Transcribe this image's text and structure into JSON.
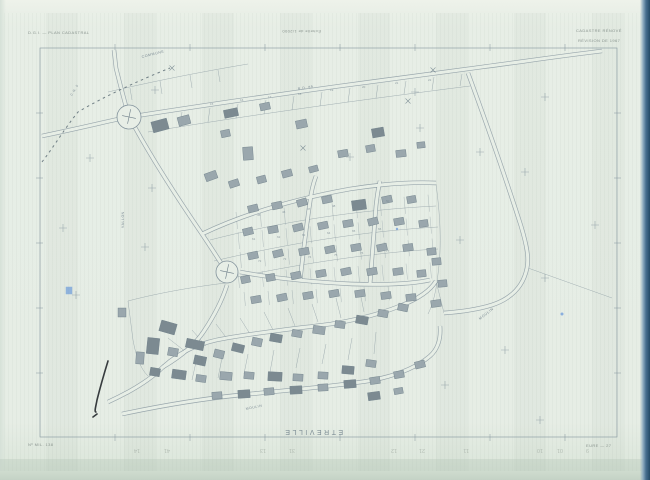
{
  "sheet": {
    "title": "Plan cadastral – feuille scannée"
  },
  "header": {
    "left": "D.G.I. — PLAN CADASTRAL",
    "scale": "Échelle de 1/2000",
    "right1": "CADASTRE RÉNOVÉ",
    "right2": "RÉVISION DE 1967"
  },
  "footer": {
    "left": "Nº MIL. 138",
    "right": "EURE — 27",
    "commune": "ETREVILLE"
  },
  "colors": {
    "paper": "#e7eee6",
    "ink": "#84949d",
    "ink_dark": "#6d7e88",
    "building": "#9aa7ad",
    "building_dark": "#7c8a91",
    "boundary": "#5d6d76",
    "text": "#7c8b94",
    "pencil": "#a7b1a8",
    "blue": "#4d86d8",
    "pen": "#23282c"
  },
  "map": {
    "border": {
      "x": 40,
      "y": 48,
      "w": 577,
      "h": 389,
      "xticks": [
        115,
        190,
        265,
        340,
        415,
        490,
        565
      ],
      "yticks": [
        113,
        178,
        243,
        308,
        373
      ]
    },
    "roads": [
      "M42,136 C90,126 112,120 129,117 C180,109 260,97 340,86 C400,78 452,71 482,67 C520,62 560,56 602,51",
      "M129,117 C124,100 120,84 116,68 L114,50",
      "M132,122 C150,155 176,196 202,234 C214,252 221,263 226,271",
      "M240,272 C272,278 312,282 352,284 C385,285 412,284 430,280",
      "M227,285 C222,301 214,316 204,331 C195,345 180,357 163,367",
      "M108,402 C130,392 150,380 163,367 C182,350 202,342 227,338 C262,332 300,328 331,324 C356,320 380,314 400,306 C418,299 430,291 436,281",
      "M122,414 C160,406 200,399 240,395 C280,391 330,387 368,381 C396,376 416,368 430,356 C438,349 441,338 440,326",
      "M300,281 C303,255 306,228 310,202 C311,193 313,184 316,176",
      "M370,284 C372,258 374,232 376,206 C377,197 378,189 380,181",
      "M468,73 C486,122 505,176 521,226 C527,246 529,258 527,268 C523,288 510,299 492,305 C476,310 458,312 444,313",
      "M202,234 C248,212 300,198 350,189 C382,184 412,182 436,183"
    ],
    "parcel_lines": [
      "M148,132 C250,115 360,100 470,86",
      "M180,127 L182,112",
      "M208,122 L210,108",
      "M236,118 L238,104",
      "M264,114 L266,100",
      "M292,110 L294,96",
      "M320,106 L322,92",
      "M348,102 L350,88",
      "M376,98 L378,85",
      "M404,94 L406,81",
      "M432,90 L434,77",
      "M460,86 L462,74",
      "M108,92 C150,82 200,72 248,64",
      "M130,88 L132,100",
      "M160,81 L162,94",
      "M190,75 L192,88",
      "M218,70 L220,82",
      "M436,184 C440,214 442,244 438,274 C436,292 433,304 428,314",
      "M210,240 C280,222 356,210 436,206",
      "M214,261 C290,243 366,231 438,227",
      "M219,281 C300,263 380,252 438,249",
      "M468,74 C488,128 508,182 524,232 C529,247 530,258 528,268",
      "M528,268 C556,278 584,288 612,298",
      "M128,301 C162,292 200,286 226,283",
      "M128,301 L133,340 C136,356 140,368 148,376",
      "M168,338 L186,352",
      "M192,330 L206,346",
      "M216,324 L228,340",
      "M240,318 L250,334",
      "M264,312 L273,330",
      "M288,308 L295,326",
      "M312,304 L318,322",
      "M336,298 L341,318",
      "M360,292 L364,312",
      "M196,362 L192,380",
      "M222,358 L218,378",
      "M248,354 L244,374",
      "M274,350 L270,372",
      "M300,348 L296,368",
      "M326,344 L322,364",
      "M352,338 L348,360",
      "M376,332 L374,354",
      "M436,281 L444,313"
    ],
    "lot_bands": [
      {
        "x0": 236,
        "x1": 430,
        "step": 24,
        "y0": 212,
        "h": 17,
        "slope": -0.09
      },
      {
        "x0": 238,
        "x1": 432,
        "step": 24,
        "y0": 232,
        "h": 17,
        "slope": -0.08
      },
      {
        "x0": 240,
        "x1": 432,
        "step": 24,
        "y0": 252,
        "h": 16,
        "slope": -0.07
      },
      {
        "x0": 238,
        "x1": 430,
        "step": 24,
        "y0": 272,
        "h": 16,
        "slope": -0.05
      },
      {
        "x0": 244,
        "x1": 418,
        "step": 24,
        "y0": 292,
        "h": 14,
        "slope": -0.04
      }
    ],
    "buildings": [
      [
        152,
        120,
        16,
        11,
        -15,
        1
      ],
      [
        178,
        116,
        12,
        9,
        -15,
        0
      ],
      [
        224,
        109,
        14,
        8,
        -12,
        1
      ],
      [
        260,
        103,
        10,
        7,
        -12,
        0
      ],
      [
        296,
        120,
        11,
        8,
        -12,
        0
      ],
      [
        221,
        130,
        9,
        7,
        -12,
        0
      ],
      [
        243,
        147,
        10,
        13,
        -4,
        0
      ],
      [
        205,
        172,
        12,
        8,
        -20,
        0
      ],
      [
        229,
        180,
        10,
        7,
        -18,
        0
      ],
      [
        257,
        176,
        9,
        7,
        -15,
        0
      ],
      [
        282,
        170,
        10,
        7,
        -15,
        0
      ],
      [
        309,
        166,
        9,
        6,
        -15,
        0
      ],
      [
        338,
        150,
        10,
        7,
        -10,
        0
      ],
      [
        366,
        145,
        9,
        7,
        -10,
        0
      ],
      [
        396,
        150,
        10,
        7,
        -6,
        0
      ],
      [
        417,
        142,
        8,
        6,
        -6,
        0
      ],
      [
        372,
        128,
        12,
        9,
        -10,
        1
      ],
      [
        248,
        205,
        10,
        7,
        -14,
        0
      ],
      [
        272,
        202,
        10,
        7,
        -12,
        0
      ],
      [
        297,
        199,
        10,
        7,
        -16,
        0
      ],
      [
        322,
        196,
        10,
        7,
        -12,
        0
      ],
      [
        352,
        200,
        14,
        10,
        -8,
        1
      ],
      [
        382,
        196,
        10,
        7,
        -12,
        0
      ],
      [
        407,
        196,
        9,
        7,
        -10,
        0
      ],
      [
        243,
        228,
        10,
        7,
        -14,
        0
      ],
      [
        268,
        226,
        10,
        7,
        -10,
        0
      ],
      [
        293,
        224,
        10,
        7,
        -14,
        0
      ],
      [
        318,
        222,
        10,
        7,
        -12,
        0
      ],
      [
        343,
        220,
        10,
        7,
        -10,
        0
      ],
      [
        368,
        218,
        10,
        7,
        -14,
        0
      ],
      [
        394,
        218,
        10,
        7,
        -10,
        0
      ],
      [
        419,
        220,
        9,
        7,
        -8,
        0
      ],
      [
        248,
        252,
        10,
        7,
        -12,
        0
      ],
      [
        273,
        250,
        10,
        7,
        -14,
        0
      ],
      [
        299,
        248,
        10,
        7,
        -10,
        0
      ],
      [
        325,
        246,
        10,
        7,
        -12,
        0
      ],
      [
        351,
        244,
        10,
        7,
        -10,
        0
      ],
      [
        377,
        244,
        10,
        7,
        -12,
        0
      ],
      [
        403,
        244,
        10,
        7,
        -8,
        0
      ],
      [
        427,
        248,
        9,
        7,
        -6,
        0
      ],
      [
        241,
        276,
        9,
        7,
        -12,
        0
      ],
      [
        266,
        274,
        9,
        7,
        -10,
        0
      ],
      [
        291,
        272,
        10,
        7,
        -12,
        0
      ],
      [
        316,
        270,
        10,
        7,
        -10,
        0
      ],
      [
        341,
        268,
        10,
        7,
        -12,
        0
      ],
      [
        367,
        268,
        10,
        7,
        -10,
        0
      ],
      [
        393,
        268,
        10,
        7,
        -8,
        0
      ],
      [
        417,
        270,
        9,
        7,
        -6,
        0
      ],
      [
        251,
        296,
        10,
        7,
        -10,
        0
      ],
      [
        277,
        294,
        10,
        7,
        -12,
        0
      ],
      [
        303,
        292,
        10,
        7,
        -10,
        0
      ],
      [
        329,
        290,
        10,
        7,
        -10,
        0
      ],
      [
        355,
        290,
        10,
        7,
        -8,
        0
      ],
      [
        381,
        292,
        10,
        7,
        -8,
        0
      ],
      [
        406,
        294,
        10,
        7,
        -6,
        0
      ],
      [
        432,
        258,
        9,
        7,
        -5,
        0
      ],
      [
        438,
        280,
        9,
        7,
        -5,
        0
      ],
      [
        431,
        300,
        10,
        7,
        -8,
        0
      ],
      [
        160,
        322,
        16,
        11,
        16,
        1
      ],
      [
        147,
        338,
        12,
        16,
        6,
        1
      ],
      [
        168,
        348,
        10,
        8,
        10,
        0
      ],
      [
        186,
        340,
        18,
        9,
        12,
        1
      ],
      [
        194,
        356,
        12,
        9,
        12,
        1
      ],
      [
        214,
        350,
        10,
        8,
        14,
        0
      ],
      [
        232,
        344,
        12,
        8,
        14,
        1
      ],
      [
        252,
        338,
        10,
        8,
        12,
        0
      ],
      [
        270,
        334,
        12,
        8,
        10,
        1
      ],
      [
        292,
        330,
        10,
        7,
        10,
        0
      ],
      [
        313,
        326,
        12,
        8,
        8,
        0
      ],
      [
        335,
        321,
        10,
        7,
        8,
        0
      ],
      [
        356,
        316,
        12,
        8,
        10,
        1
      ],
      [
        378,
        310,
        10,
        7,
        10,
        0
      ],
      [
        398,
        304,
        10,
        7,
        12,
        0
      ],
      [
        136,
        352,
        8,
        12,
        4,
        0
      ],
      [
        150,
        368,
        10,
        8,
        10,
        1
      ],
      [
        172,
        370,
        14,
        9,
        8,
        1
      ],
      [
        196,
        375,
        10,
        7,
        8,
        0
      ],
      [
        220,
        372,
        12,
        8,
        5,
        0
      ],
      [
        244,
        372,
        10,
        7,
        5,
        0
      ],
      [
        268,
        372,
        14,
        9,
        3,
        1
      ],
      [
        293,
        374,
        10,
        7,
        3,
        0
      ],
      [
        318,
        372,
        10,
        7,
        3,
        0
      ],
      [
        342,
        366,
        12,
        8,
        5,
        1
      ],
      [
        366,
        360,
        10,
        7,
        8,
        0
      ],
      [
        118,
        308,
        8,
        9,
        0,
        0
      ],
      [
        212,
        392,
        10,
        7,
        -4,
        0
      ],
      [
        238,
        390,
        12,
        8,
        -4,
        1
      ],
      [
        264,
        388,
        10,
        7,
        -5,
        0
      ],
      [
        290,
        386,
        12,
        8,
        -3,
        1
      ],
      [
        318,
        384,
        10,
        7,
        -3,
        0
      ],
      [
        344,
        380,
        12,
        8,
        -5,
        1
      ],
      [
        370,
        377,
        10,
        7,
        -8,
        0
      ],
      [
        394,
        371,
        10,
        7,
        -10,
        0
      ],
      [
        415,
        361,
        10,
        7,
        -14,
        0
      ],
      [
        368,
        392,
        12,
        8,
        -8,
        1
      ],
      [
        394,
        388,
        9,
        6,
        -10,
        0
      ]
    ],
    "crosses": [
      [
        155,
        90
      ],
      [
        415,
        92
      ],
      [
        545,
        97
      ],
      [
        90,
        158
      ],
      [
        350,
        157
      ],
      [
        480,
        152
      ],
      [
        525,
        172
      ],
      [
        63,
        228
      ],
      [
        152,
        188
      ],
      [
        145,
        247
      ],
      [
        460,
        240
      ],
      [
        545,
        278
      ],
      [
        76,
        295
      ],
      [
        505,
        350
      ],
      [
        540,
        420
      ],
      [
        445,
        385
      ],
      [
        595,
        225
      ],
      [
        420,
        128
      ]
    ],
    "xmarks": [
      [
        433,
        70
      ],
      [
        408,
        101
      ],
      [
        303,
        148
      ],
      [
        172,
        68
      ]
    ],
    "boundary": {
      "d": "M42,162 C55,145 65,128 78,112 C105,96 140,80 170,68",
      "dash": "2.5,3.5"
    },
    "roundabouts": [
      {
        "cx": 129,
        "cy": 117,
        "r": 12
      },
      {
        "cx": 227,
        "cy": 272,
        "r": 11
      }
    ],
    "labels": [
      {
        "t": "COMMUNE",
        "x": 142,
        "y": 58,
        "r": -14,
        "s": 3.6
      },
      {
        "t": "C.R. 5",
        "x": 72,
        "y": 96,
        "r": -58,
        "s": 3.2
      },
      {
        "t": "R.D. 89",
        "x": 298,
        "y": 90,
        "r": -9,
        "s": 3.4
      },
      {
        "t": "VALLON",
        "x": 124,
        "y": 228,
        "r": -90,
        "s": 3.4
      },
      {
        "t": "MOULIN",
        "x": 480,
        "y": 320,
        "r": -38,
        "s": 3.6
      },
      {
        "t": "MOULIN",
        "x": 246,
        "y": 410,
        "r": -12,
        "s": 3.4
      }
    ],
    "numbers": [
      [
        210,
        105,
        "15"
      ],
      [
        240,
        101,
        "16"
      ],
      [
        268,
        98,
        "17"
      ],
      [
        298,
        95,
        "18"
      ],
      [
        330,
        91,
        "19"
      ],
      [
        362,
        88,
        "20"
      ],
      [
        395,
        84,
        "21"
      ],
      [
        428,
        81,
        "22"
      ],
      [
        257,
        216,
        "45"
      ],
      [
        282,
        213,
        "46"
      ],
      [
        307,
        210,
        "47"
      ],
      [
        332,
        207,
        "48"
      ],
      [
        358,
        204,
        "49"
      ],
      [
        386,
        202,
        "50"
      ],
      [
        252,
        240,
        "61"
      ],
      [
        277,
        238,
        "62"
      ],
      [
        302,
        236,
        "63"
      ],
      [
        327,
        234,
        "64"
      ],
      [
        352,
        232,
        "65"
      ],
      [
        378,
        230,
        "66"
      ],
      [
        258,
        262,
        "72"
      ],
      [
        283,
        260,
        "73"
      ],
      [
        308,
        258,
        "74"
      ],
      [
        334,
        256,
        "75"
      ],
      [
        360,
        254,
        "76"
      ],
      [
        386,
        252,
        "77"
      ]
    ],
    "pencil_numbers": [
      {
        "x": 140,
        "t": "14"
      },
      {
        "x": 170,
        "t": "41"
      },
      {
        "x": 266,
        "t": "13"
      },
      {
        "x": 295,
        "t": "31"
      },
      {
        "x": 397,
        "t": "12"
      },
      {
        "x": 425,
        "t": "21"
      },
      {
        "x": 469,
        "t": "11"
      },
      {
        "x": 543,
        "t": "10"
      },
      {
        "x": 563,
        "t": "01"
      },
      {
        "x": 589,
        "t": "9"
      }
    ],
    "blue_marks": [
      {
        "type": "rect",
        "x": 66,
        "y": 287,
        "w": 6,
        "h": 7
      },
      {
        "type": "dot",
        "x": 562,
        "y": 314,
        "r": 1.5
      },
      {
        "type": "dot",
        "x": 397,
        "y": 229,
        "r": 1.2
      }
    ],
    "pen_stroke": {
      "d": "M108,361 C104,374 100,388 97,400 C96,406 94,412 96,412 M93,417 l4,-3"
    }
  }
}
